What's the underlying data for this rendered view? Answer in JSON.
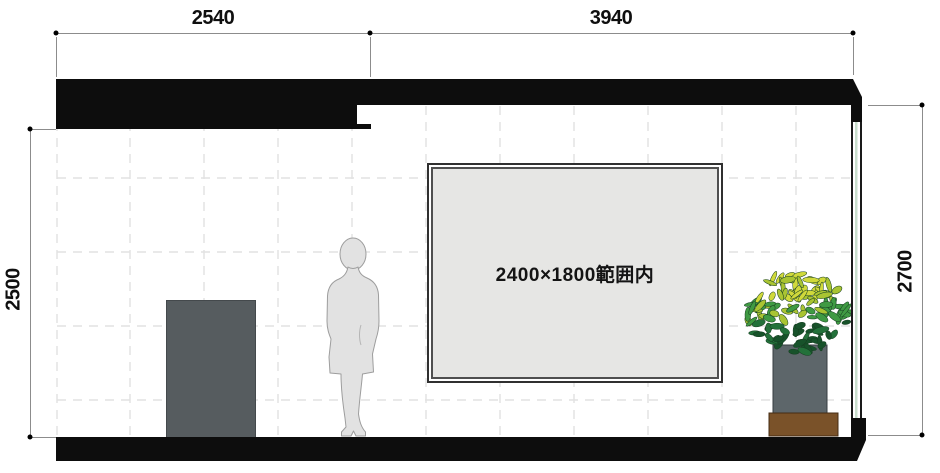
{
  "drawing": {
    "dimensions": {
      "top_left_mm": "2540",
      "top_right_mm": "3940",
      "left_height_mm": "2500",
      "right_height_mm": "2700"
    },
    "panel": {
      "label": "2400×1800範囲内"
    },
    "colors": {
      "structure_black": "#0d0d0d",
      "panel_fill": "#e6e6e4",
      "pedestal_gray": "#565c5f",
      "person_gray": "#e2e2e2",
      "person_outline": "#9d9d9d",
      "planter_gray": "#5d666a",
      "planter_base_brown": "#7a5229",
      "leaf_greens": [
        "#17522a",
        "#23713a",
        "#3f9a43",
        "#a9c432",
        "#d0d93b"
      ],
      "glazing_green": "#c9decd",
      "dim_line_gray": "#8c8c8c",
      "grid_gray": "#e2e2e2"
    }
  }
}
